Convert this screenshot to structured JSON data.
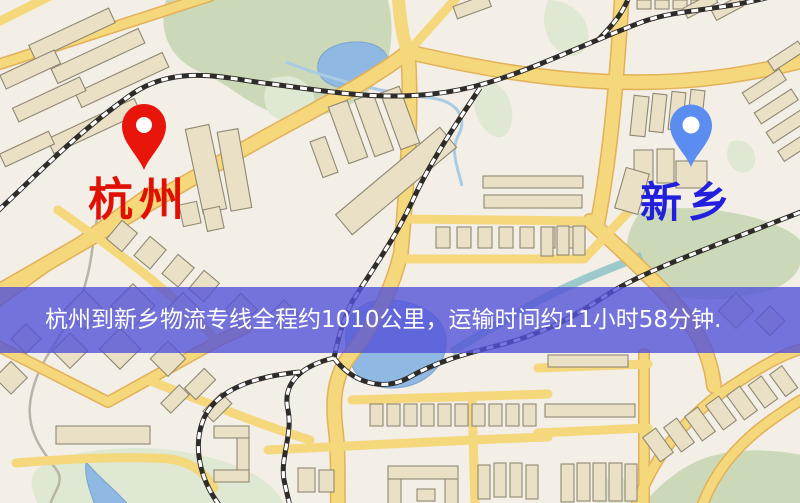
{
  "banner": {
    "text": "杭州到新乡物流专线全程约1010公里，运输时间约11小时58分钟."
  },
  "map": {
    "origin": {
      "name": "杭州",
      "pin_color": "#e8150b"
    },
    "destination": {
      "name": "新乡",
      "pin_color": "#5b8cf0"
    },
    "route": {
      "distance_km": "1010",
      "duration": "11小时58分钟"
    }
  },
  "palette": {
    "background": "#f3eee6",
    "road": "#f5d77c",
    "road_casing": "#e2b158",
    "building": "#eae0c6",
    "building_outline": "#8f8872",
    "green": "#cbd9b8",
    "green_pale": "#dfe8d2",
    "water": "#8fb9e3",
    "rail": "#2e2b28",
    "origin_pin": "#e8150b",
    "destination_pin": "#5b8cf0",
    "origin_label": "#e11005",
    "destination_label": "#2121dd",
    "banner_bg": "rgba(84,82,216,0.8)",
    "banner_text": "#ffffff"
  }
}
